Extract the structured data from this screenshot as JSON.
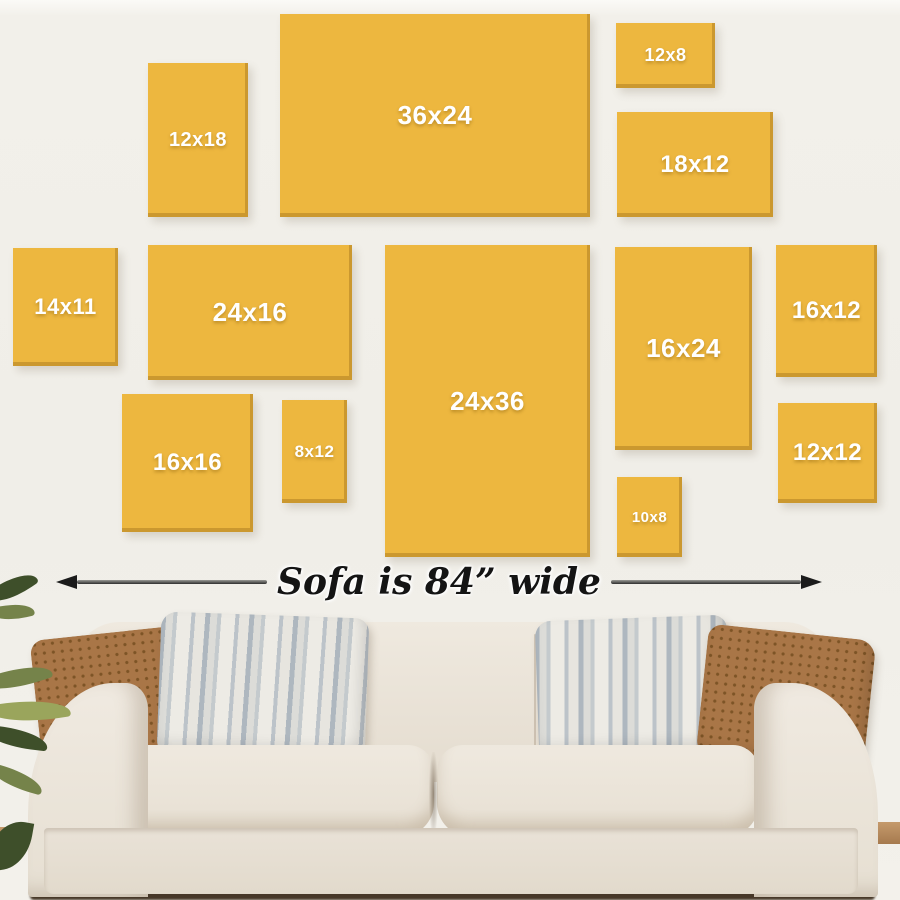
{
  "wall": {
    "background": "#f0eee8"
  },
  "frames": {
    "color": "#edb73f",
    "edge_color": "#c2922d",
    "label_color": "#ffffff",
    "items": [
      {
        "label": "12x18",
        "x": 148,
        "y": 63,
        "w": 100,
        "h": 154,
        "fs": 20
      },
      {
        "label": "36x24",
        "x": 280,
        "y": 14,
        "w": 310,
        "h": 203,
        "fs": 26
      },
      {
        "label": "12x8",
        "x": 616,
        "y": 23,
        "w": 99,
        "h": 65,
        "fs": 18
      },
      {
        "label": "18x12",
        "x": 617,
        "y": 112,
        "w": 156,
        "h": 105,
        "fs": 24
      },
      {
        "label": "14x11",
        "x": 13,
        "y": 248,
        "w": 105,
        "h": 118,
        "fs": 22
      },
      {
        "label": "24x16",
        "x": 148,
        "y": 245,
        "w": 204,
        "h": 135,
        "fs": 26
      },
      {
        "label": "24x36",
        "x": 385,
        "y": 245,
        "w": 205,
        "h": 312,
        "fs": 26
      },
      {
        "label": "16x24",
        "x": 615,
        "y": 247,
        "w": 137,
        "h": 203,
        "fs": 26
      },
      {
        "label": "16x12",
        "x": 776,
        "y": 245,
        "w": 101,
        "h": 132,
        "fs": 24
      },
      {
        "label": "16x16",
        "x": 122,
        "y": 394,
        "w": 131,
        "h": 138,
        "fs": 24
      },
      {
        "label": "8x12",
        "x": 282,
        "y": 400,
        "w": 65,
        "h": 103,
        "fs": 17
      },
      {
        "label": "10x8",
        "x": 617,
        "y": 477,
        "w": 65,
        "h": 80,
        "fs": 15
      },
      {
        "label": "12x12",
        "x": 778,
        "y": 403,
        "w": 99,
        "h": 100,
        "fs": 24
      }
    ]
  },
  "dimension": {
    "text": "Sofa is 84” wide",
    "line_color": "#2e2e2e"
  },
  "sofa": {
    "fabric": "#eae3d8",
    "base": "#e6dfd3",
    "shadow": "#cfc4b0"
  },
  "pillows": {
    "brown": "#a97647",
    "brown_dot": "#7d5426",
    "gray_base": "#e4e2dc",
    "gray_stripe": "#aeb7bf"
  },
  "floor": {
    "wood": "#b2825a",
    "shadow": "#473828"
  },
  "plant": {
    "greens": [
      "#3e4f2a",
      "#75834a",
      "#9aa55c"
    ]
  }
}
